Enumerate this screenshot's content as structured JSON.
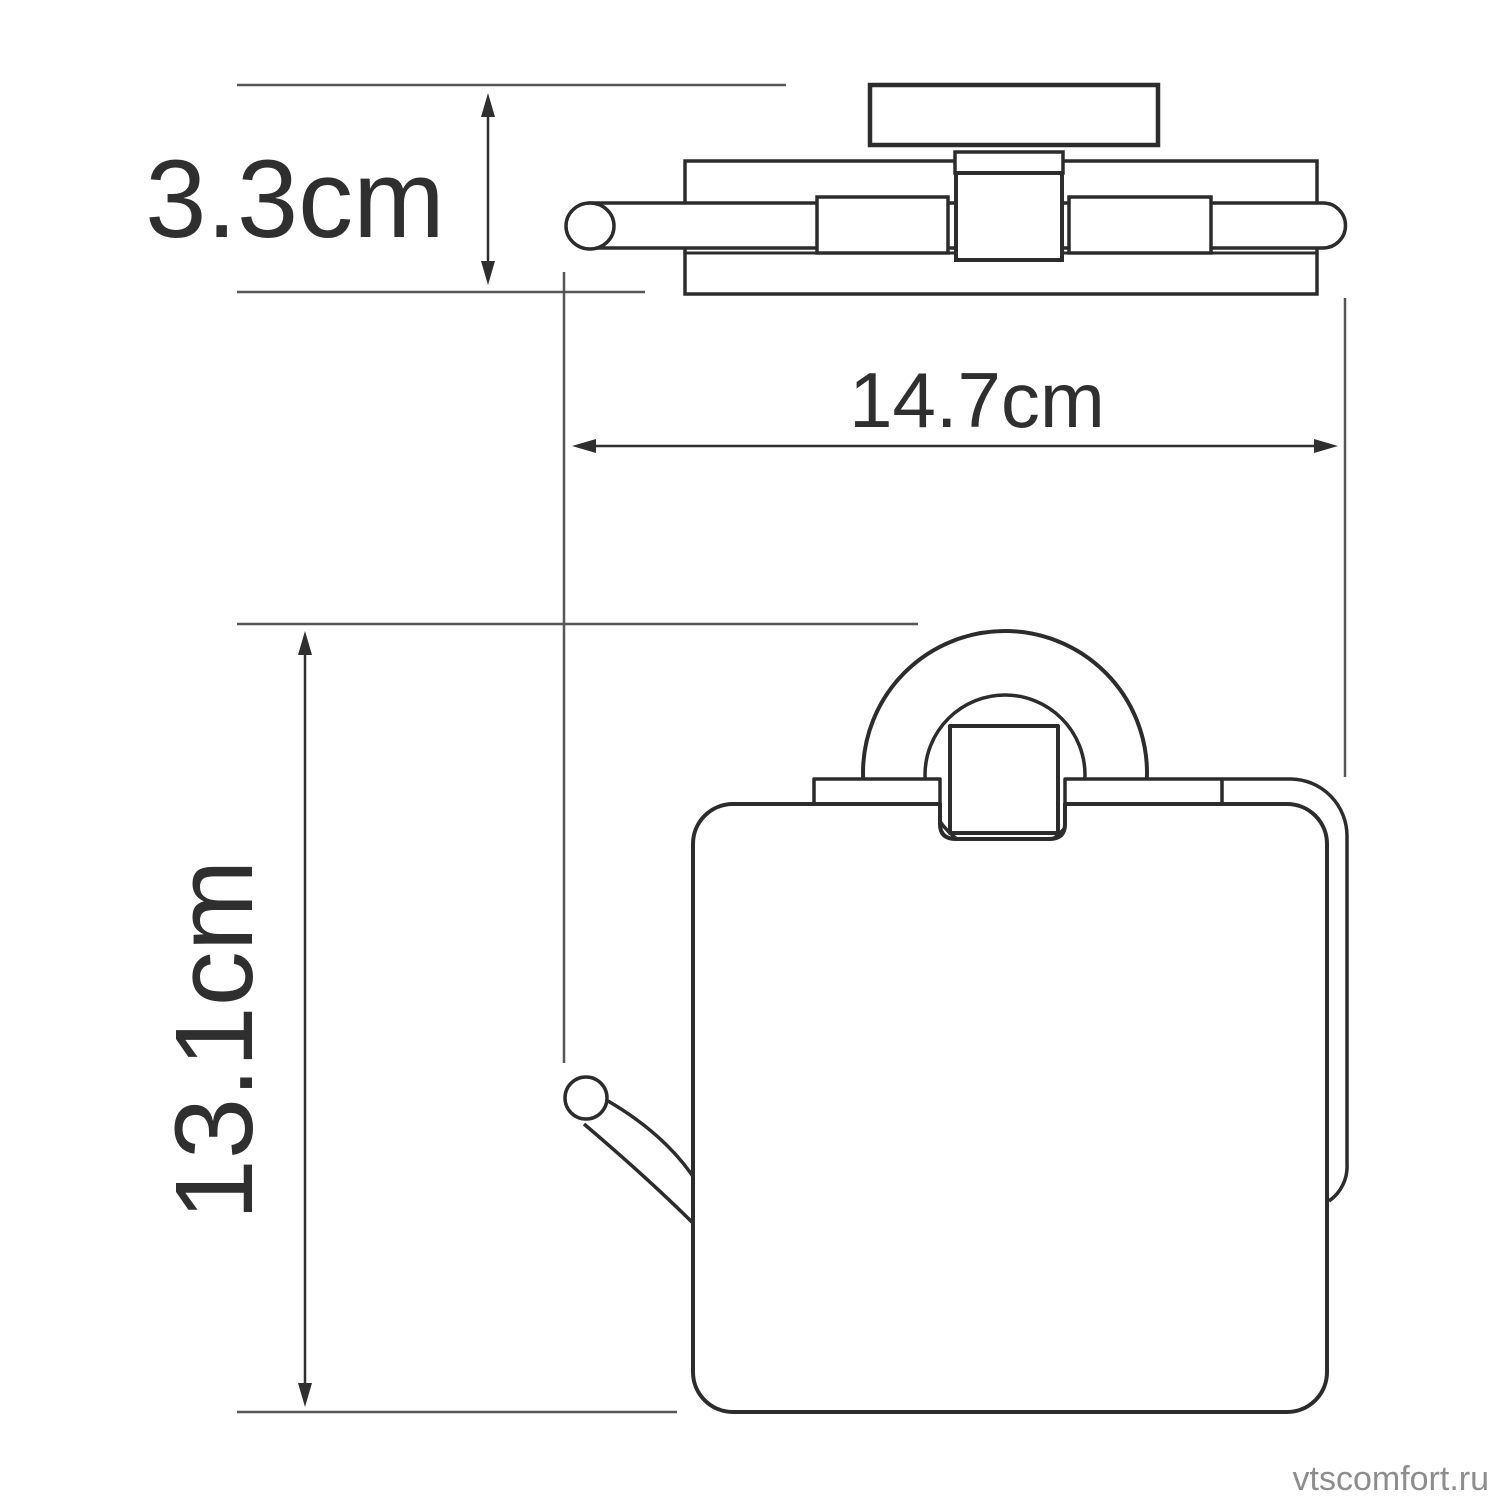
{
  "diagram": {
    "type": "technical-dimension-drawing",
    "views": [
      {
        "id": "top-view",
        "description": "toilet paper holder seen from above"
      },
      {
        "id": "front-view",
        "description": "toilet paper holder seen from the front"
      }
    ],
    "dimensions": [
      {
        "id": "depth",
        "label": "3.3cm",
        "value_cm": 3.3,
        "orientation": "vertical",
        "measures": "wall-plate to front of holder (top view)"
      },
      {
        "id": "width",
        "label": "14.7cm",
        "value_cm": 14.7,
        "orientation": "horizontal",
        "measures": "overall width of roll bar"
      },
      {
        "id": "height",
        "label": "13.1cm",
        "value_cm": 13.1,
        "orientation": "vertical",
        "measures": "overall height of holder (front view)"
      }
    ],
    "watermark": "vtscomfort.ru",
    "colors": {
      "outline": "#2c2c2c",
      "dimension_arrow": "#2f2f2f",
      "extension_line": "#565656",
      "label_text": "#2f2f2f",
      "watermark_text": "#8d8d8d",
      "background": "#ffffff"
    }
  }
}
